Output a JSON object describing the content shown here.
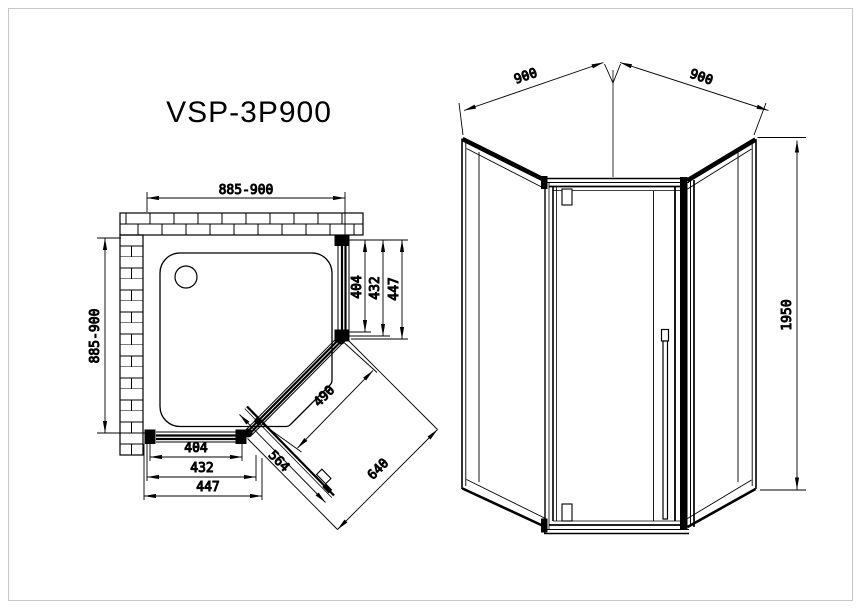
{
  "title": "VSP-3P900",
  "plan": {
    "dim_width_top": "885-900",
    "dim_depth_left": "885-900",
    "dims_side_right": [
      "404",
      "432",
      "447"
    ],
    "dims_side_bottom": [
      "404",
      "432",
      "447"
    ],
    "dim_door_opening": "490",
    "dim_door_panel": "564",
    "dim_diagonal_overall": "640"
  },
  "elevation": {
    "dim_panel_left": "900",
    "dim_panel_right": "900",
    "dim_height": "1950"
  },
  "colors": {
    "line": "#000000",
    "text": "#161616",
    "background": "#ffffff",
    "page_border": "#c8c8c8"
  }
}
